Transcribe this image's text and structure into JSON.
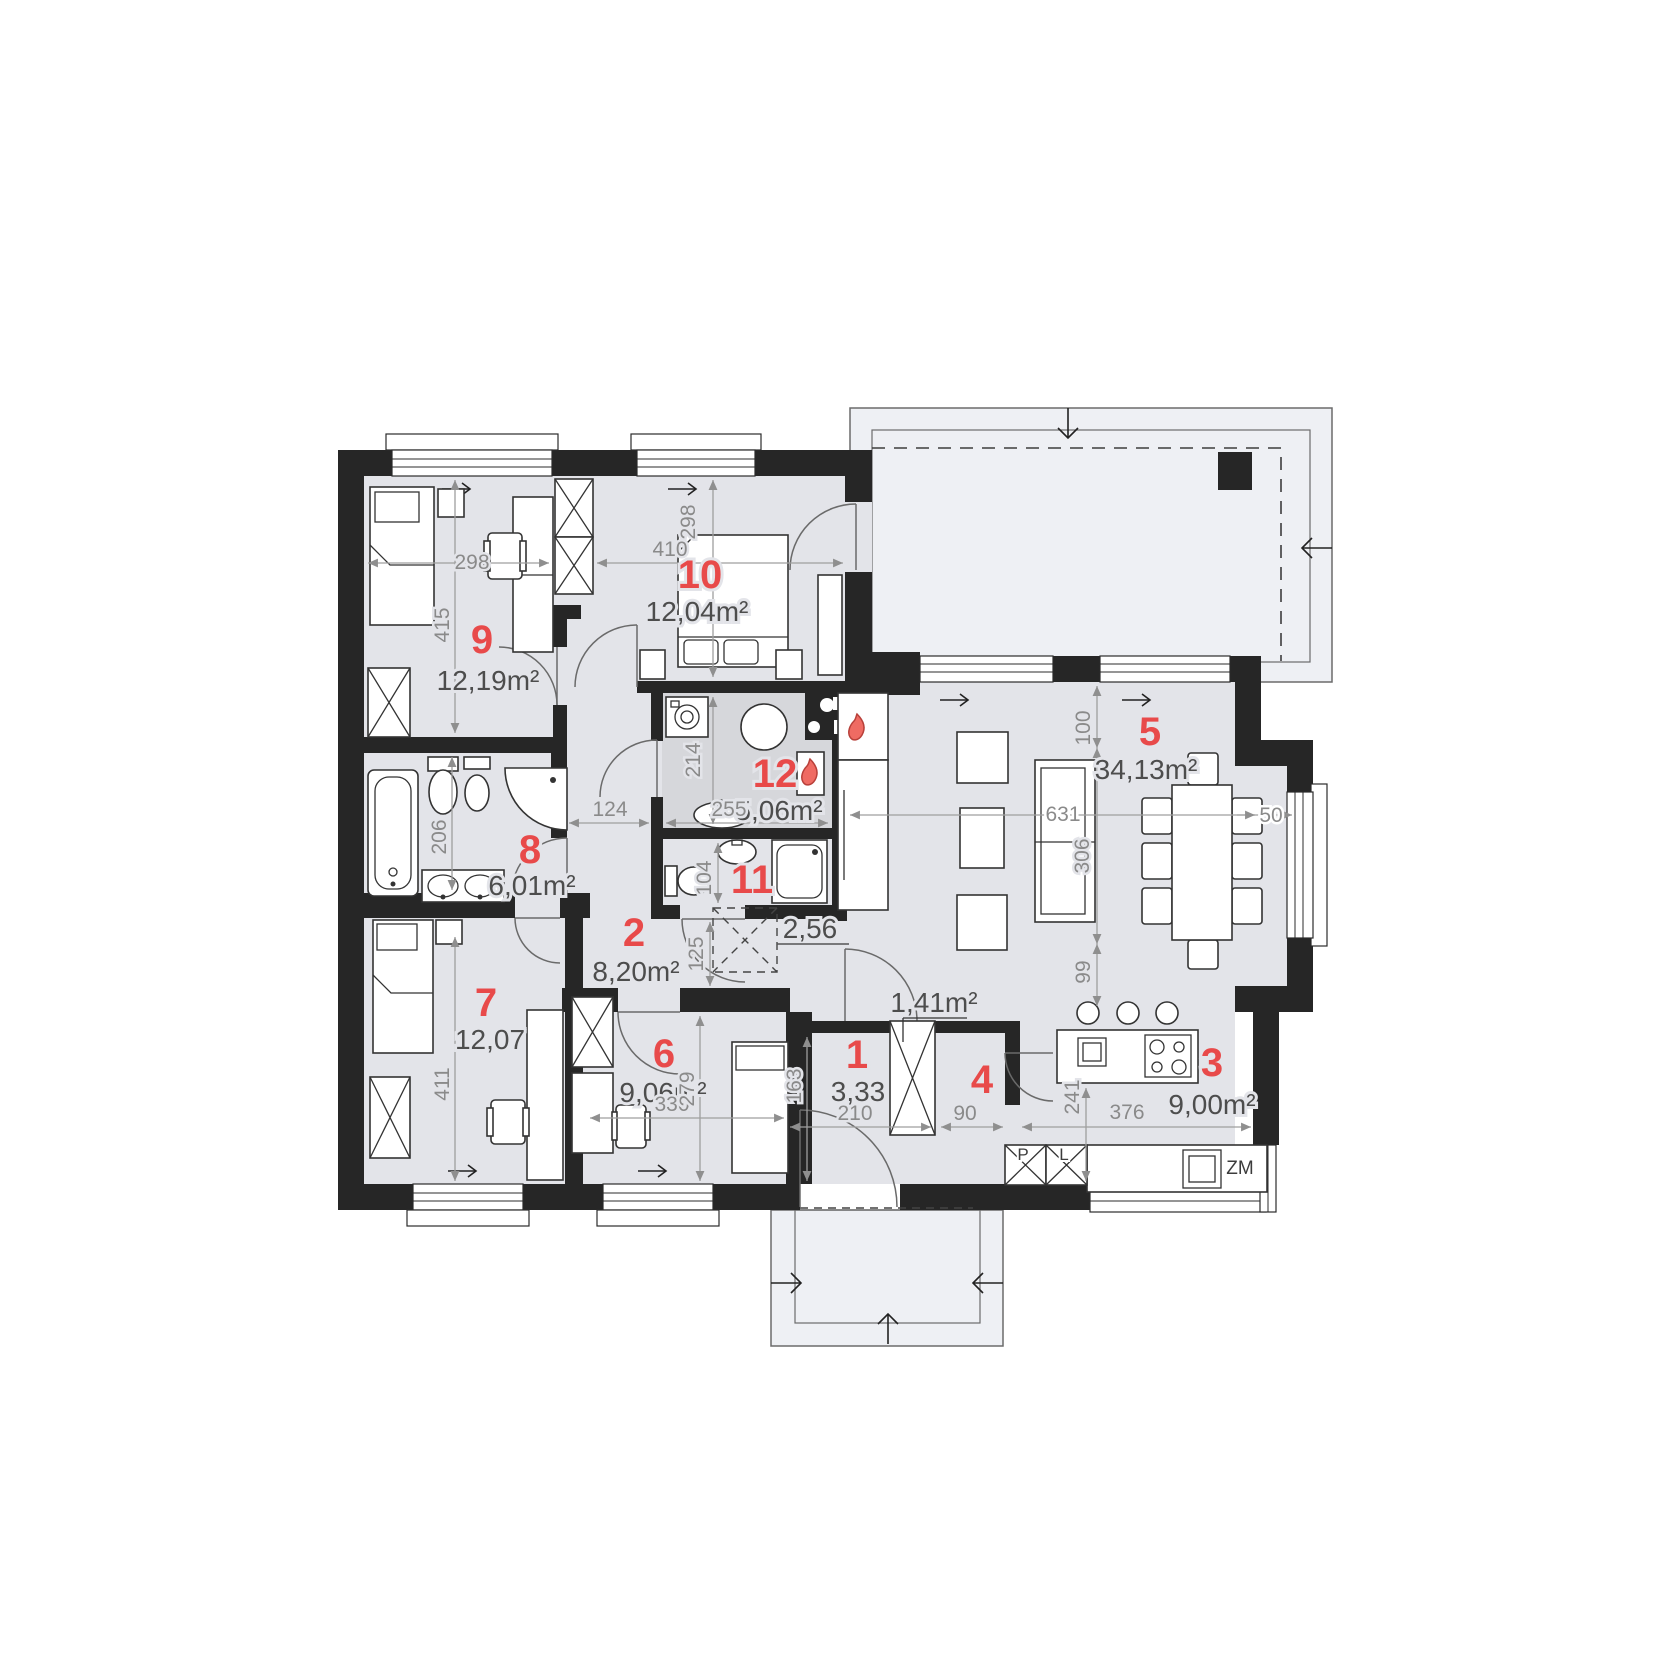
{
  "plan": {
    "accent": "#e84a4a",
    "rooms": [
      {
        "number": "1",
        "area": "3,33"
      },
      {
        "number": "2",
        "area": "8,20m²"
      },
      {
        "number": "3",
        "area": "9,00m²"
      },
      {
        "number": "4",
        "area": "1,41m²"
      },
      {
        "number": "5",
        "area": "34,13m²"
      },
      {
        "number": "6",
        "area": "9,06m²"
      },
      {
        "number": "7",
        "area": "12,07"
      },
      {
        "number": "8",
        "area": "6,01m²"
      },
      {
        "number": "9",
        "area": "12,19m²"
      },
      {
        "number": "10",
        "area": "12,04m²"
      },
      {
        "number": "11",
        "area": "2,56"
      },
      {
        "number": "12",
        "area": "5,06m²"
      }
    ],
    "dims": {
      "r9w": "298",
      "r9h": "415",
      "r10w": "410",
      "r10h": "298",
      "r12w": "255",
      "r12h": "214",
      "r11h": "104",
      "r8h": "206",
      "c124": "124",
      "c125": "125",
      "r7h": "411",
      "r6w": "330",
      "r6h": "279",
      "h1h": "163",
      "h1w": "210",
      "r4w": "90",
      "k3w": "376",
      "k3h": "241",
      "l631": "631",
      "l306": "306",
      "l100": "100",
      "l99": "99",
      "d50": "50"
    },
    "tags": {
      "p": "P",
      "l": "L",
      "zm": "ZM"
    }
  }
}
